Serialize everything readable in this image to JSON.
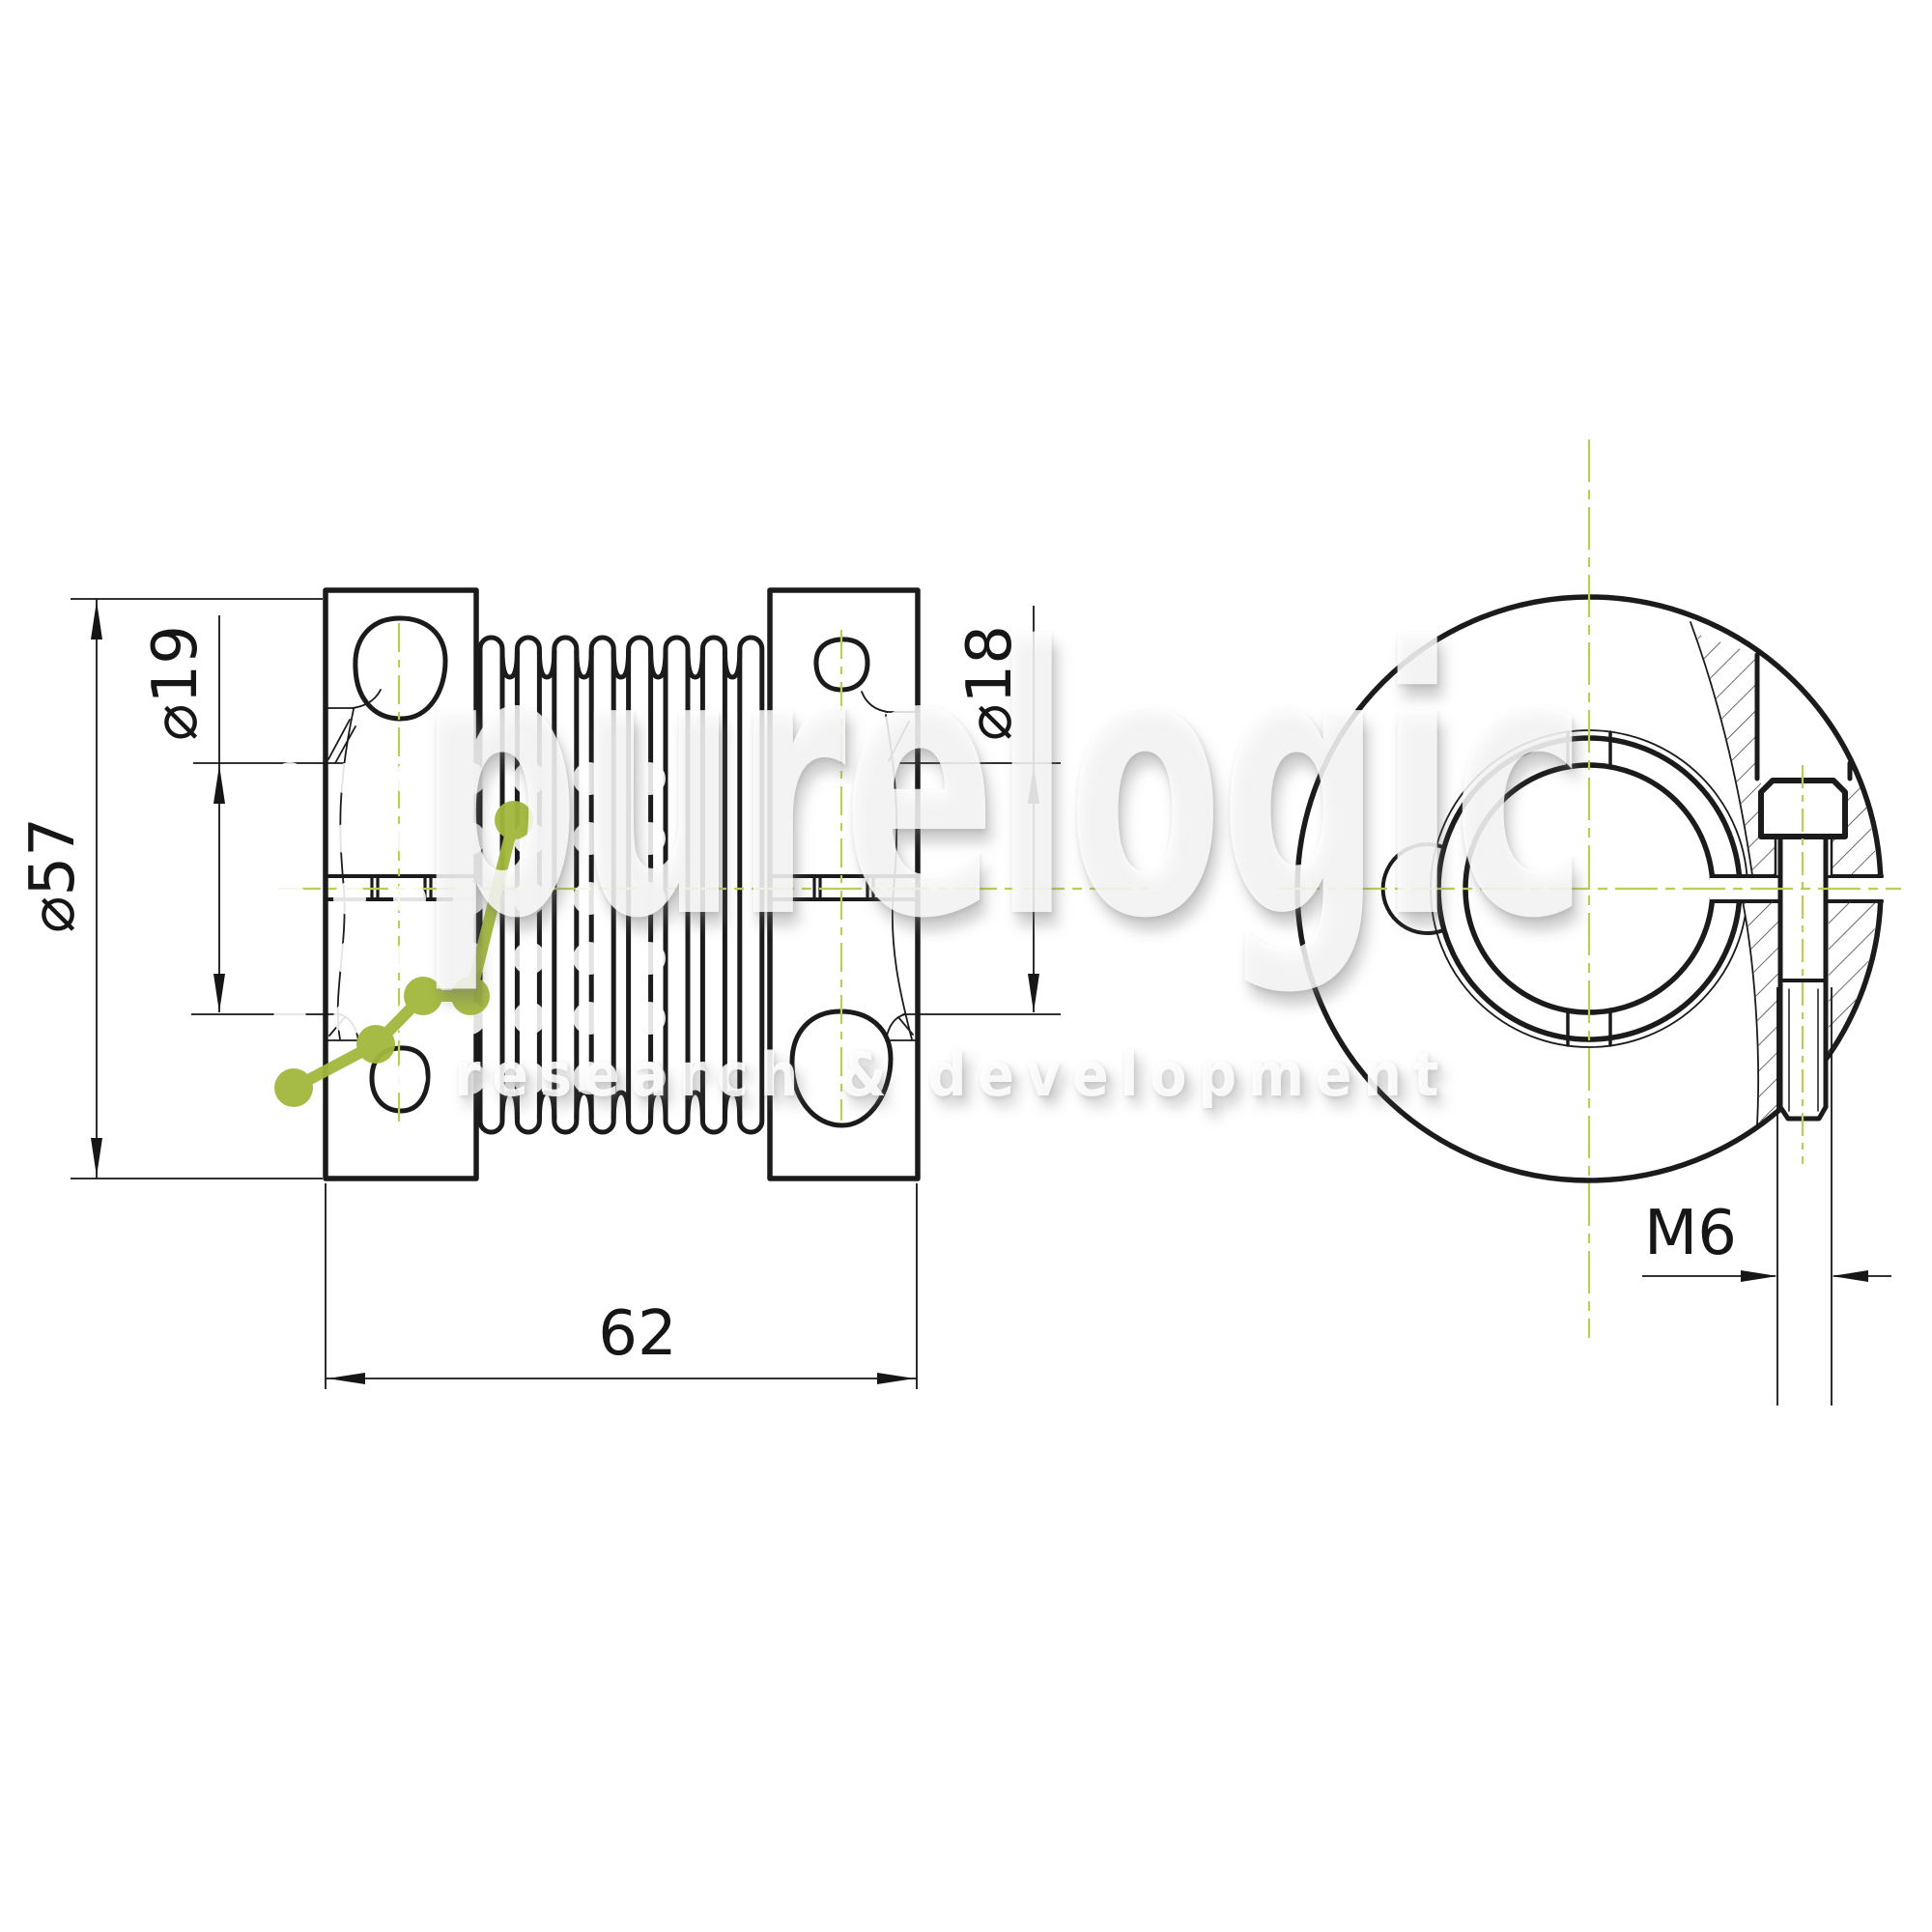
{
  "drawing": {
    "title": "bellows coupling technical drawing",
    "dimensions": {
      "outer_diameter": "⌀57",
      "bore_left": "⌀19",
      "bore_right": "⌀18",
      "length": "62",
      "screw_thread": "M6"
    },
    "colors": {
      "line": "#1b1b1b",
      "centerline_green": "#bccf55",
      "watermark_green": "#a2b83c",
      "watermark_dot": "#f0f0f0",
      "background": "#ffffff"
    }
  },
  "watermark": {
    "brand": "purelogic",
    "tagline": "research & development"
  }
}
